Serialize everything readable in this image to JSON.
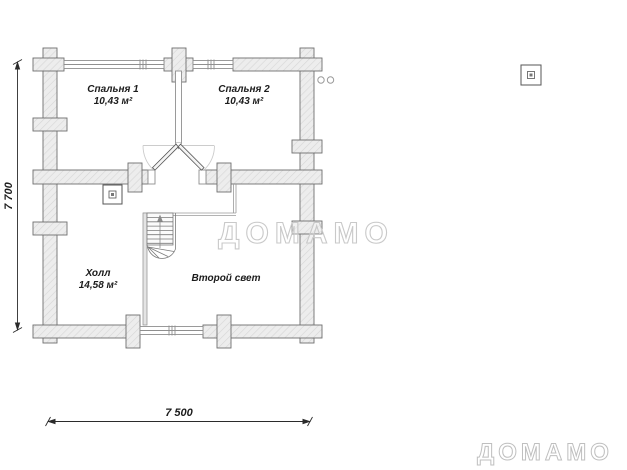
{
  "rooms": {
    "bedroom1": {
      "name": "Спальня 1",
      "area": "10,43 м²"
    },
    "bedroom2": {
      "name": "Спальня 2",
      "area": "10,43 м²"
    },
    "hall": {
      "name": "Холл",
      "area": "14,58 м²"
    },
    "second_light": {
      "name": "Второй свет"
    }
  },
  "dimensions": {
    "vertical": "7 700",
    "horizontal": "7 500"
  },
  "watermarks": {
    "center": "ДОМАМО",
    "corner": "ДОМАМО"
  },
  "colors": {
    "wall_fill": "#ededed",
    "wall_hatch": "#d6d6d6",
    "wall_stroke": "#6e6e6e",
    "thin_line": "#8f8f8f",
    "door_arc": "#cccccc",
    "watermark_stroke": "#c9c9c9",
    "text": "#1c1c1c"
  }
}
